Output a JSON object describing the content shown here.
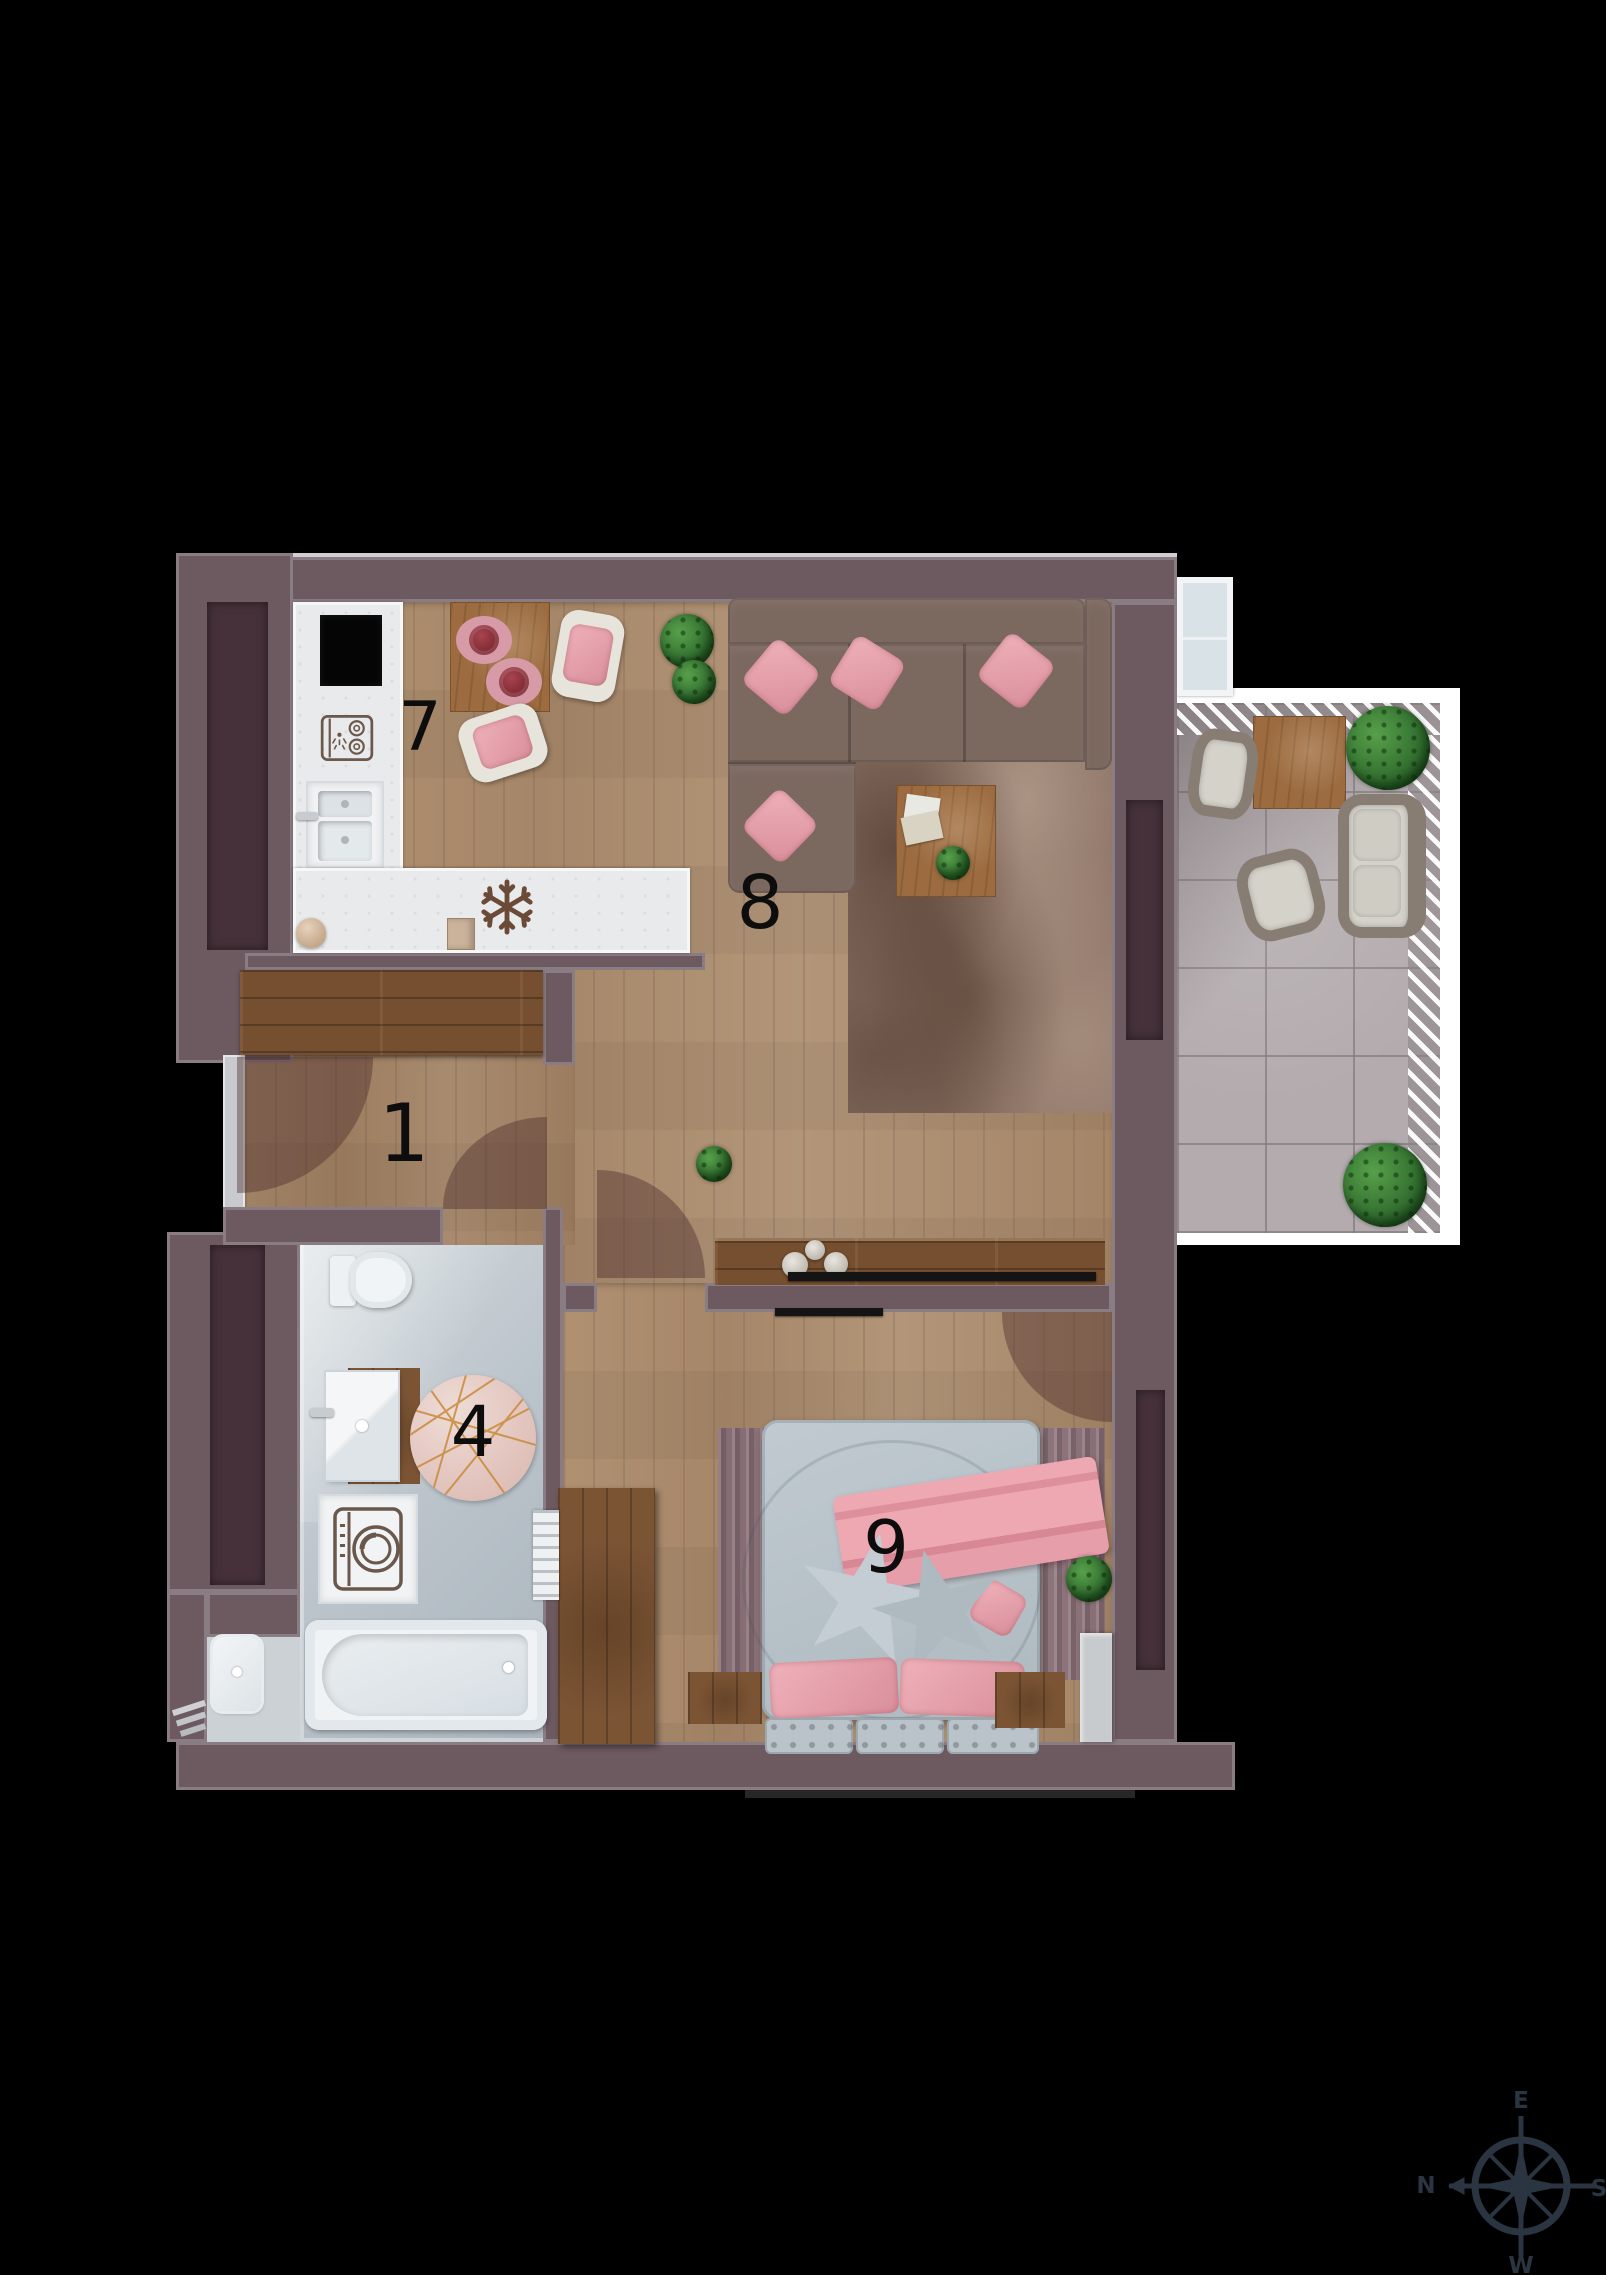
{
  "title": "apartment-floor-plan",
  "rooms": {
    "hall": {
      "number": "1"
    },
    "bathroom": {
      "number": "4"
    },
    "kitchen": {
      "number": "7"
    },
    "living": {
      "number": "8"
    },
    "bedroom": {
      "number": "9"
    }
  },
  "compass": {
    "top": "E",
    "right": "S",
    "bottom": "W",
    "left": "N"
  },
  "palette": {
    "background": "#000000",
    "wall": "#6d5a60",
    "wall_panel": "#46313a",
    "wood": "#b0937a",
    "counter": "#e9eaec",
    "bath_floor": "#c7cfd6",
    "tile": "#b3abad",
    "sofa": "#7b685f",
    "pink": "#e2a3ad",
    "rug": "#8b7265",
    "bed_gray": "#b8c2c8",
    "green": "#33702f",
    "table_wood": "#9c6b3f",
    "compass": "#2b3541",
    "tv": "#141414"
  }
}
